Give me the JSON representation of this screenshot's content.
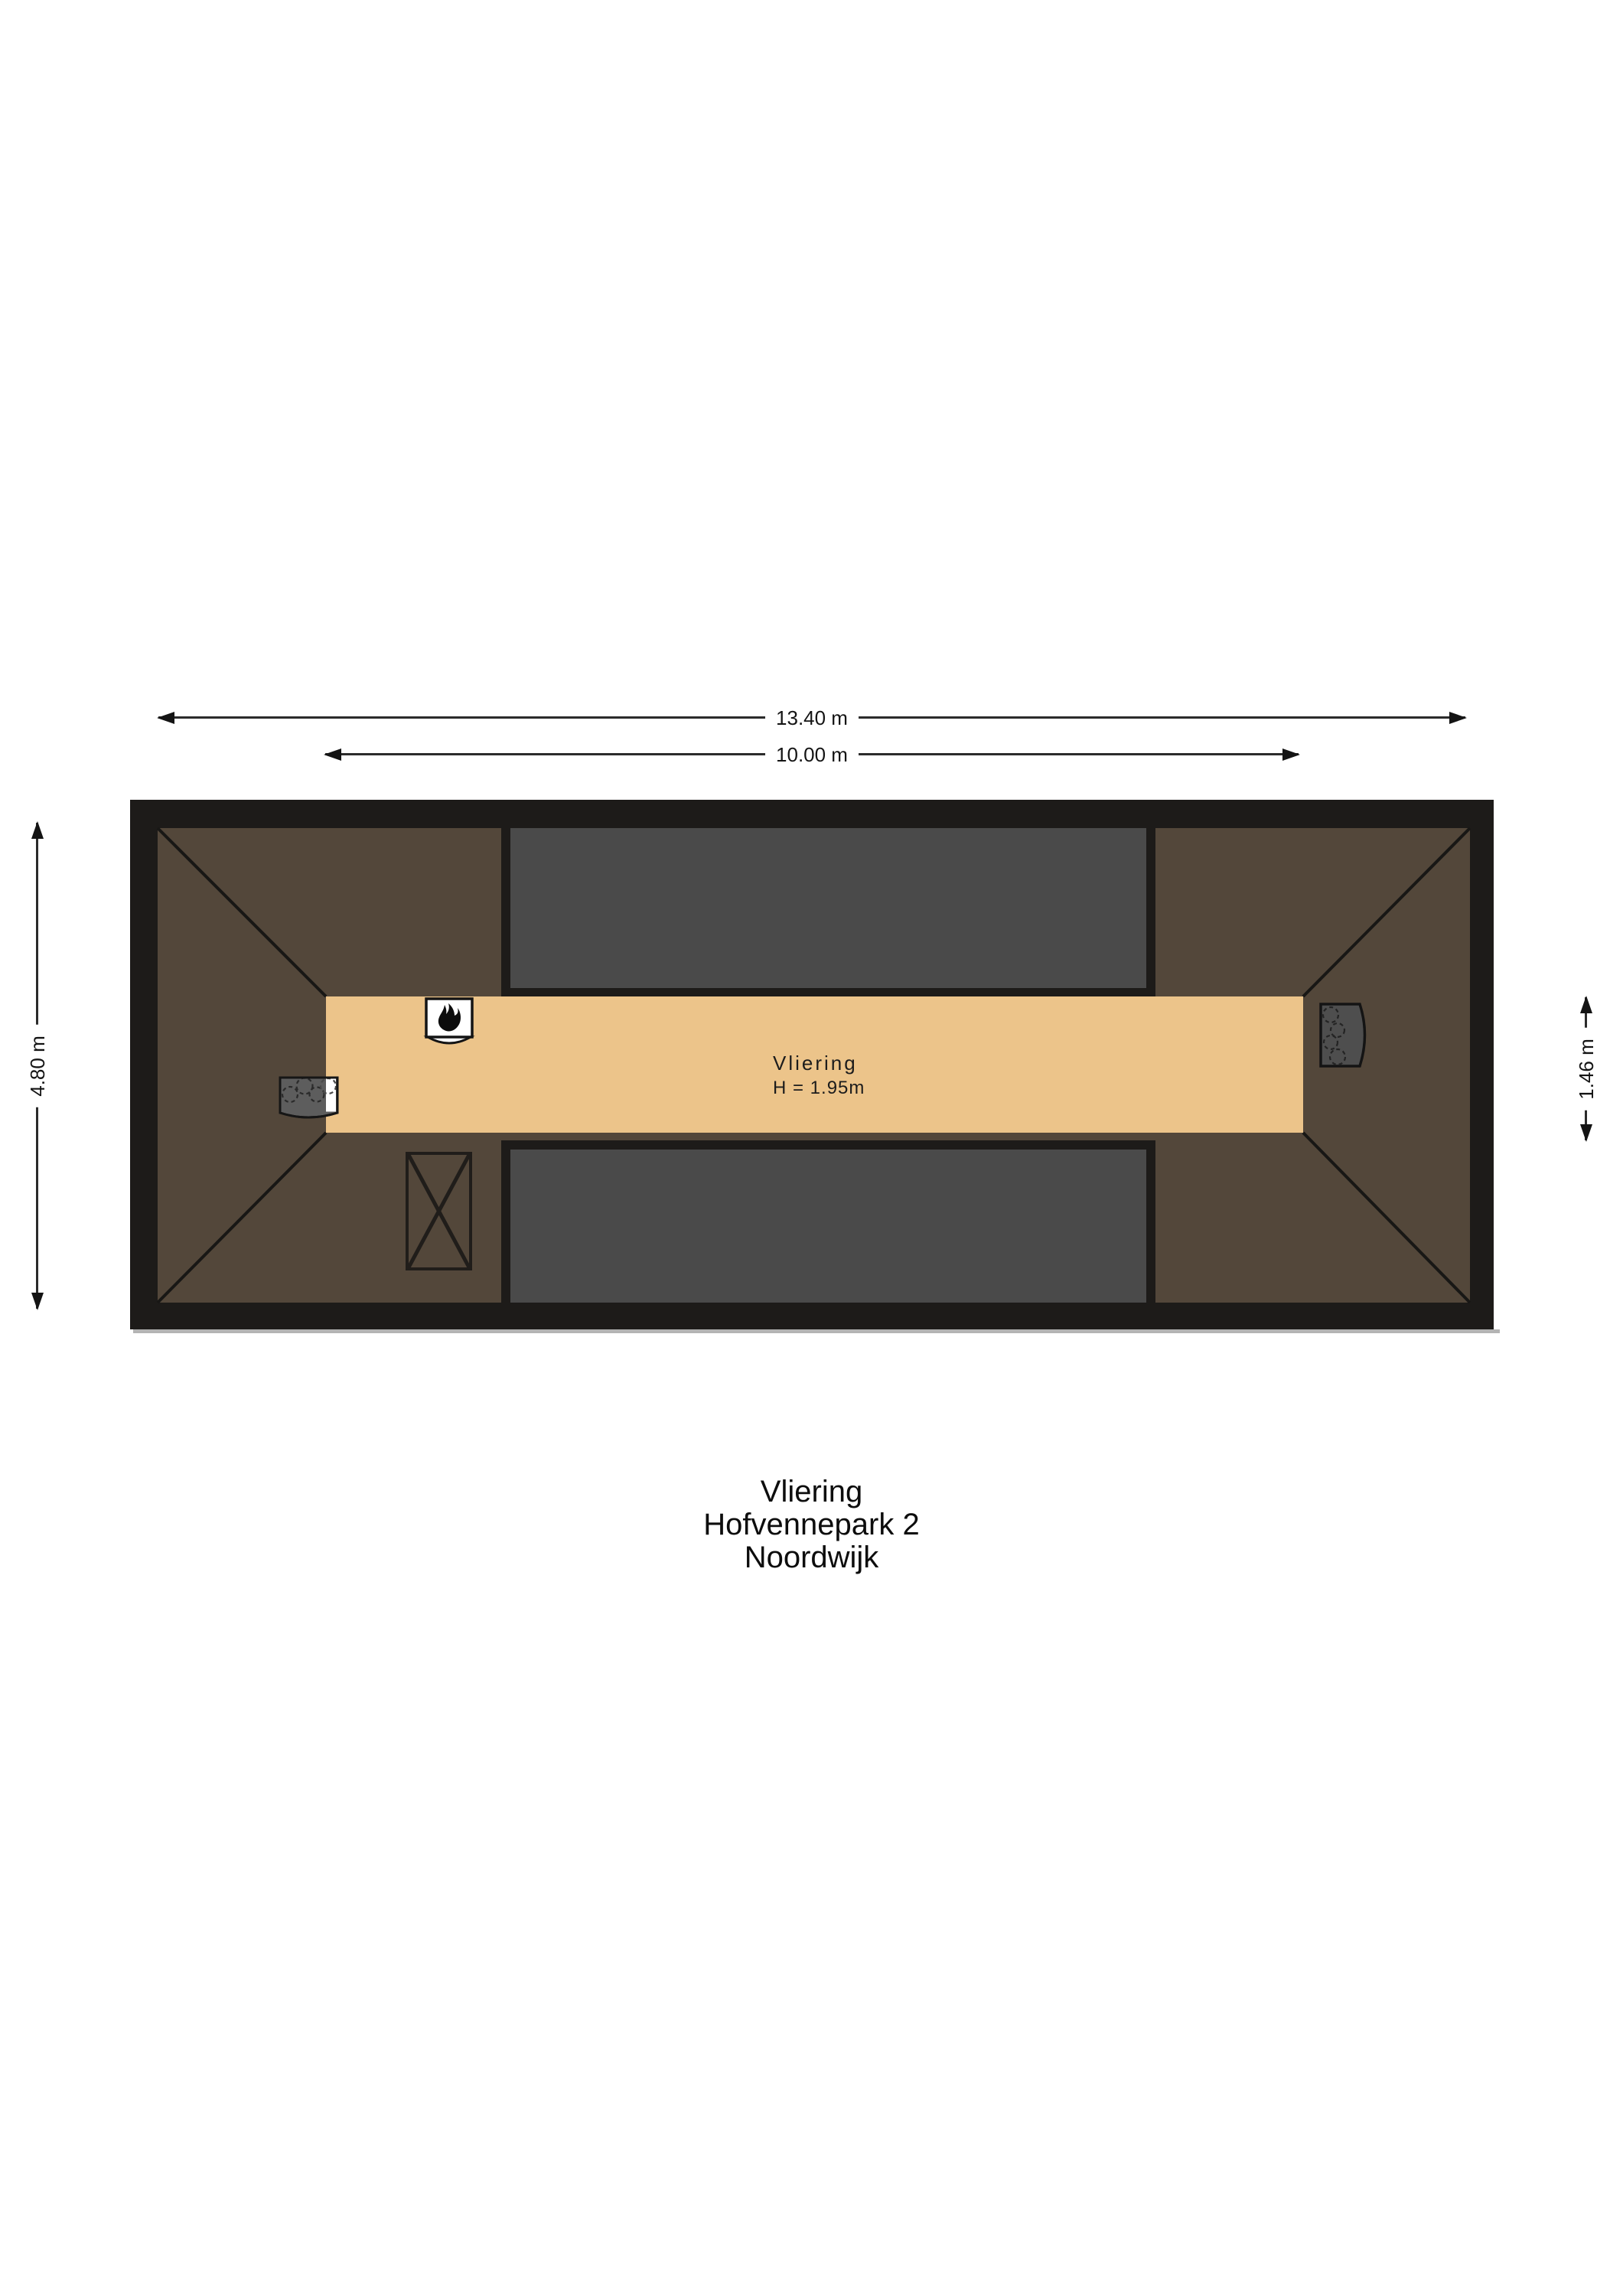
{
  "colors": {
    "wall": "#1d1b19",
    "roof": "#53473a",
    "void": "#4a4a4a",
    "floor": "#ecc48a",
    "line": "#1a1a1a",
    "background": "#ffffff"
  },
  "dimensions": {
    "outer_width": "13.40 m",
    "inner_width": "10.00 m",
    "left_height": "4.80 m",
    "right_height": "1.46 m"
  },
  "room": {
    "name": "Vliering",
    "height": "H = 1.95m"
  },
  "title": {
    "lines": [
      "Vliering",
      "Hofvennepark 2",
      "Noordwijk"
    ]
  },
  "icons": {
    "top_unit": "boiler-flame-unit",
    "left_unit": "ventilation-unit",
    "right_unit": "ventilation-unit",
    "hatch": "roof-hatch"
  }
}
